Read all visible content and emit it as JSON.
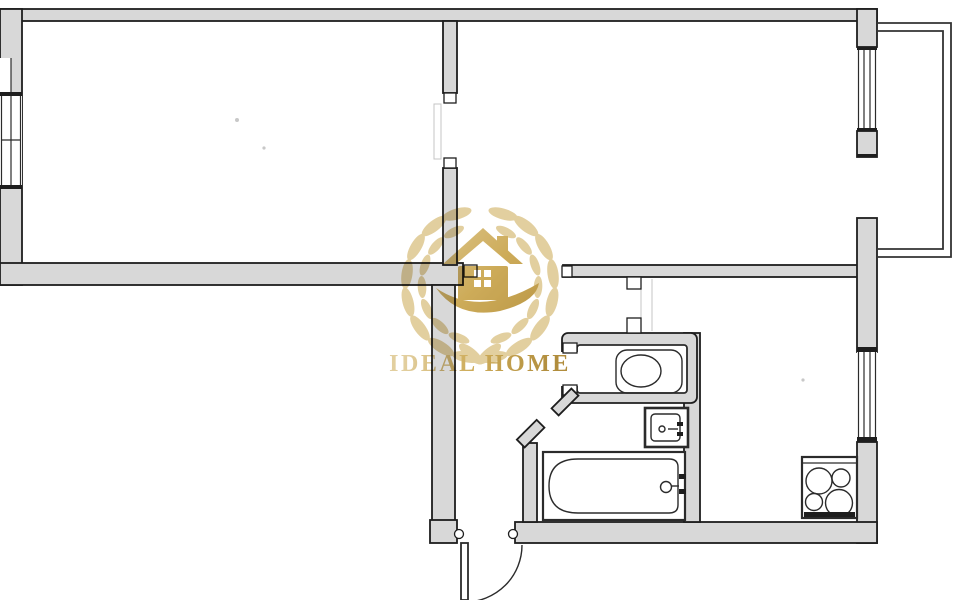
{
  "colors": {
    "background": "#ffffff",
    "wall_fill": "#d8d8d8",
    "wall_stroke": "#1e1e1e",
    "fixture_stroke": "#2b2b2b",
    "faint_line": "#c4c4c4",
    "gold_light": "#e0cb97",
    "gold": "#c9a44a",
    "gold_dark": "#aa832c"
  },
  "watermark": {
    "brand": "IDEAL HOME"
  },
  "plan": {
    "type": "apartment-floor-plan",
    "fixtures": [
      "toilet",
      "sink",
      "bathtub",
      "stove"
    ],
    "doors": [
      "entrance-door",
      "room-divider-door",
      "hall-door",
      "wc-door",
      "bathroom-door",
      "balcony-door",
      "kitchen-passage"
    ],
    "windows": [
      "left-window",
      "top-right-window",
      "kitchen-window"
    ],
    "balcony": "balcony-railing"
  }
}
